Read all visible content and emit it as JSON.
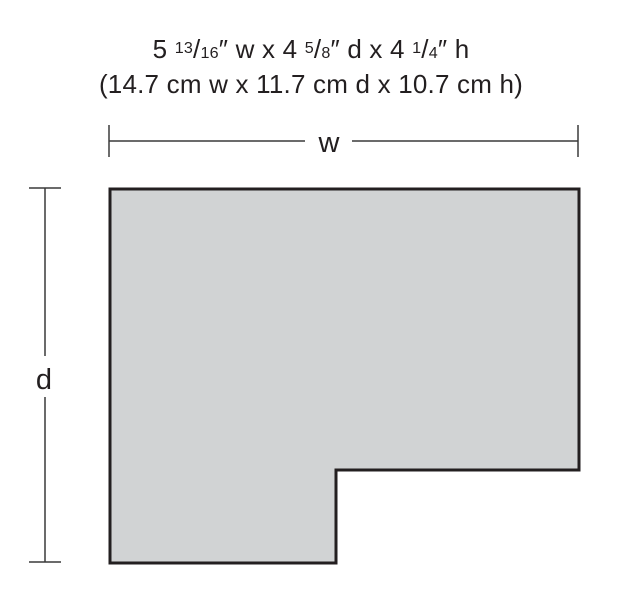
{
  "colors": {
    "background": "#ffffff",
    "shape_fill": "#d1d3d4",
    "shape_stroke": "#231f20",
    "dimension_line": "#3a3a3a",
    "text": "#231f20"
  },
  "title": {
    "imperial_parts": [
      {
        "type": "text",
        "value": "5 "
      },
      {
        "type": "fraction",
        "numerator": "13",
        "denominator": "16"
      },
      {
        "type": "text",
        "value": "″ w x 4 "
      },
      {
        "type": "fraction",
        "numerator": "5",
        "denominator": "8"
      },
      {
        "type": "text",
        "value": "″ d x 4 "
      },
      {
        "type": "fraction",
        "numerator": "1",
        "denominator": "4"
      },
      {
        "type": "text",
        "value": "″ h"
      }
    ],
    "metric": "(14.7 cm w x 11.7 cm d x 10.7 cm h)"
  },
  "labels": {
    "width": "w",
    "depth": "d"
  }
}
